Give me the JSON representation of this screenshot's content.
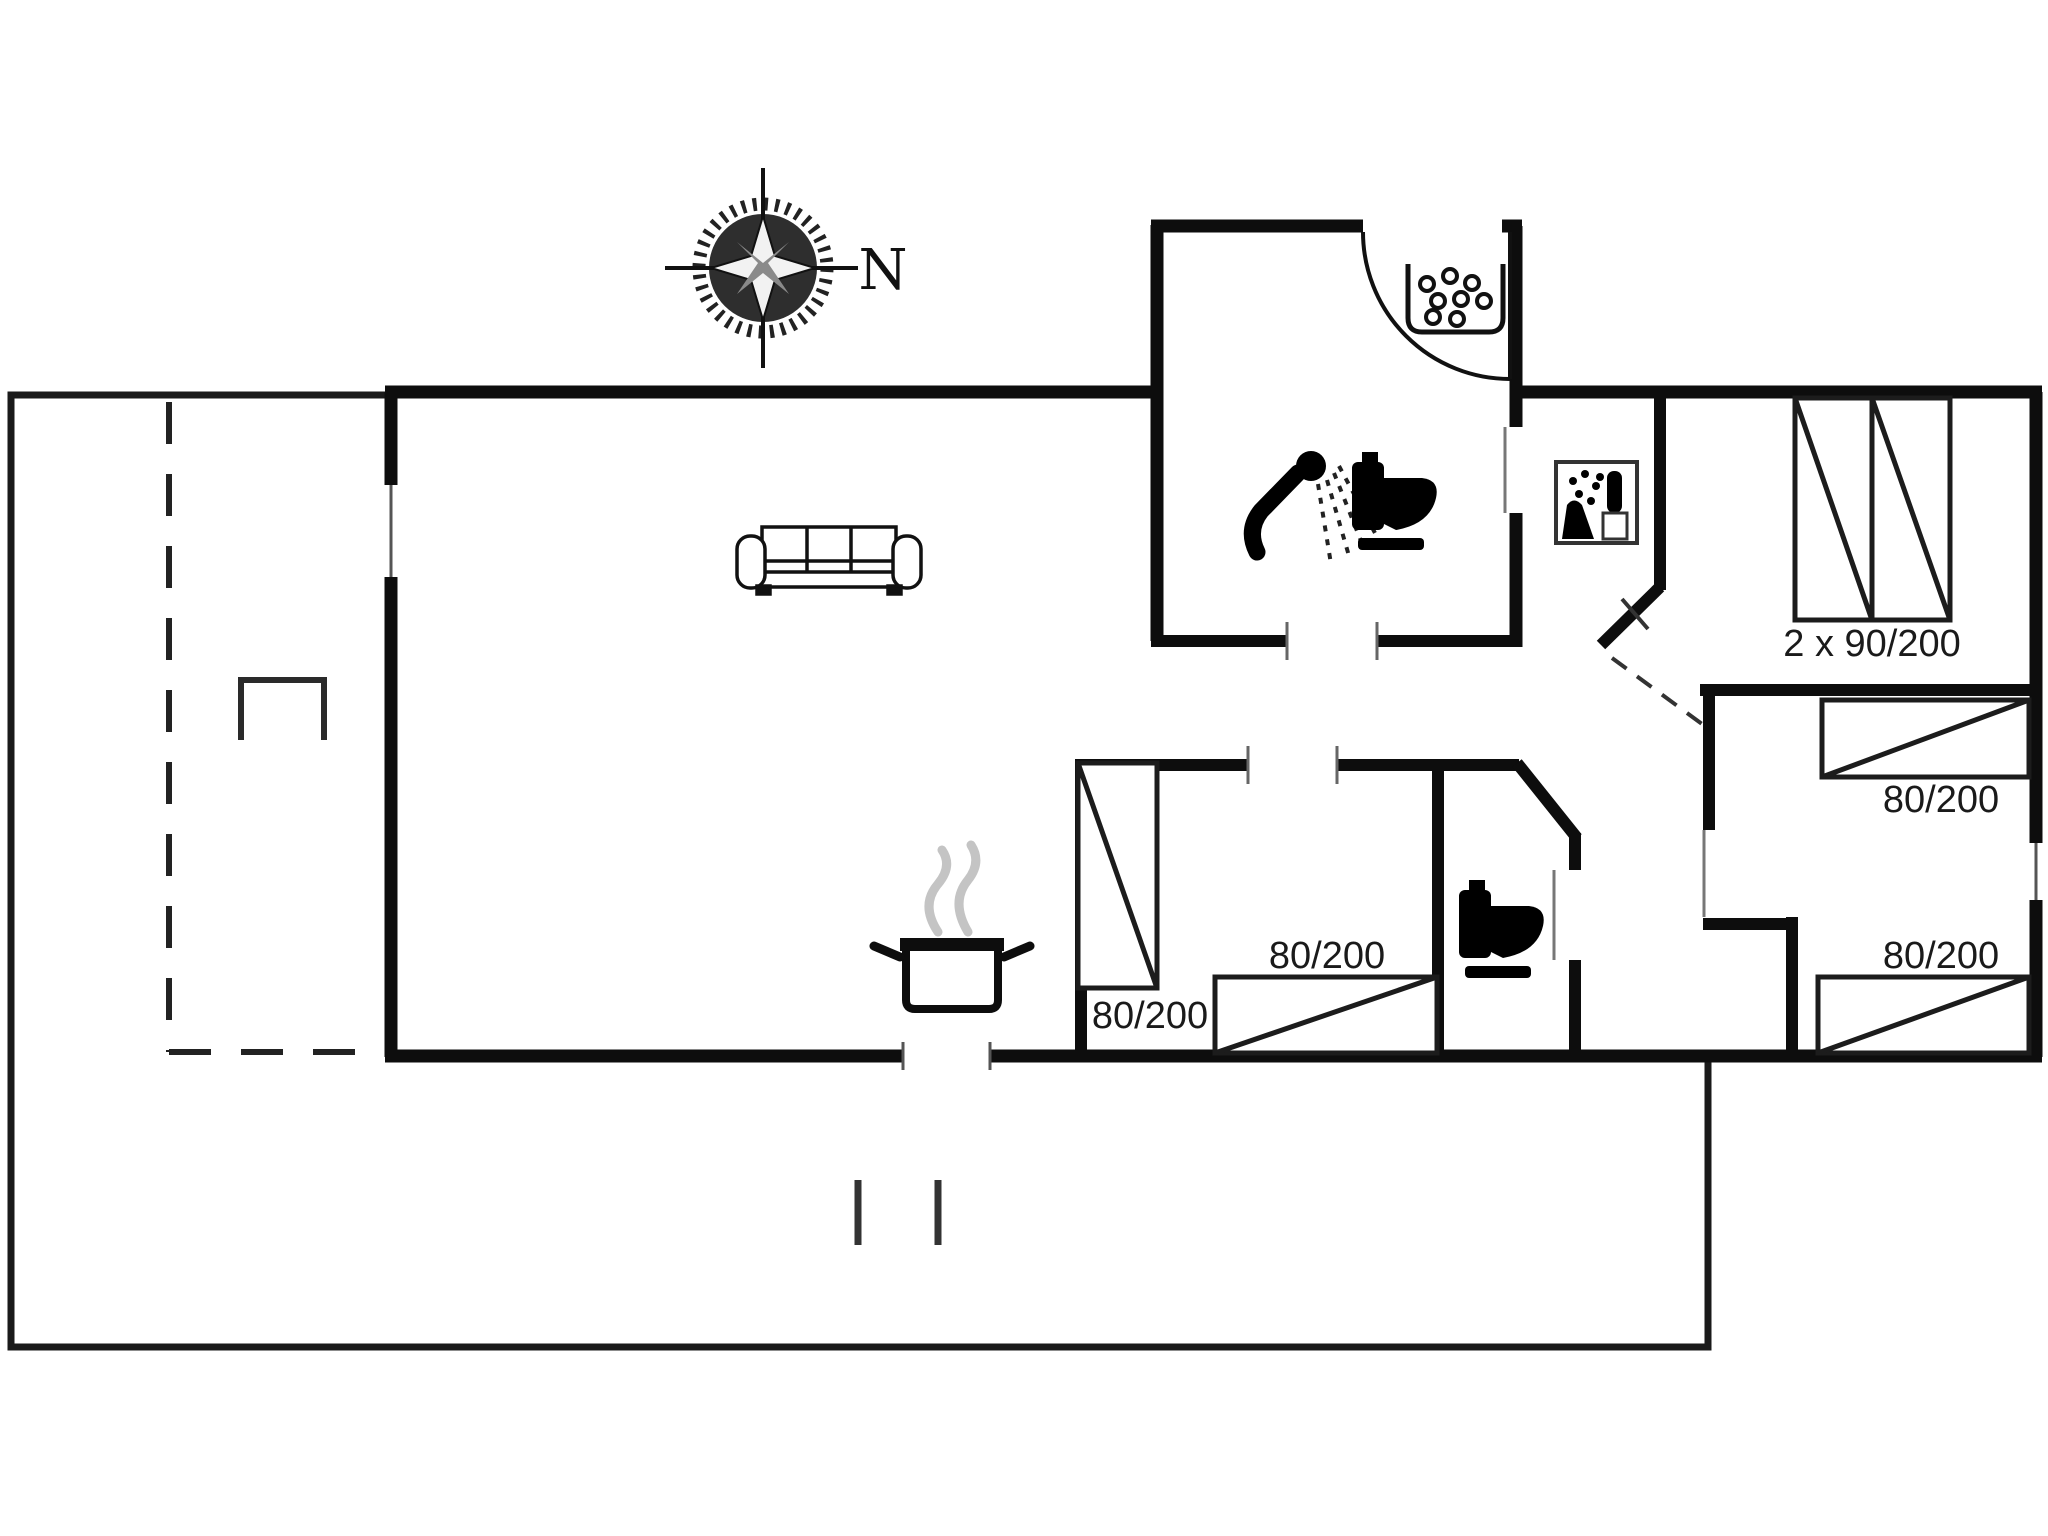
{
  "document": {
    "type": "floor-plan",
    "description": "Single storey holiday house floor plan with terrace"
  },
  "compass": {
    "north_label": "N"
  },
  "beds": [
    {
      "name": "bedroom-northeast-double-bed",
      "label": "2 x 90/200"
    },
    {
      "name": "bedroom-east-bed-top",
      "label": "80/200"
    },
    {
      "name": "bedroom-east-bed-bottom",
      "label": "80/200"
    },
    {
      "name": "bedroom-middle-bed-vertical",
      "label": "80/200"
    },
    {
      "name": "bedroom-middle-bed-horizontal",
      "label": "80/200"
    }
  ],
  "icons": {
    "compass": "compass-rose-icon",
    "sofa": "sofa-icon",
    "cooking_pot": "cooking-pot-icon",
    "shower": "shower-icon",
    "toilet_bathroom": "toilet-icon",
    "toilet_wc": "toilet-icon",
    "washbasin": "washbasin-icon",
    "utility": "washing-machine-icon",
    "grill": "grill-icon",
    "beds": "bed-icon"
  },
  "colors": {
    "wall": "#0d0d0d",
    "outline": "#1a1a1a",
    "background": "#ffffff",
    "steam": "#c4c4c4",
    "text": "#1a1a1a"
  }
}
